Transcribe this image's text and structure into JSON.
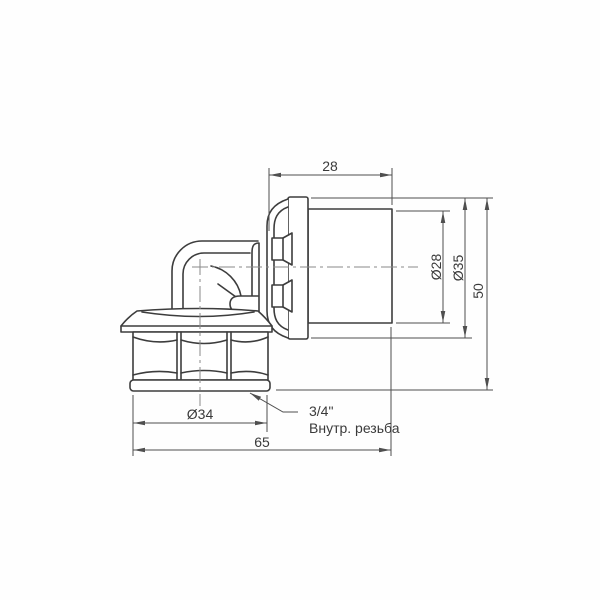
{
  "drawing": {
    "type": "technical-dimension-drawing",
    "subject": "press-elbow-fitting-with-female-thread",
    "colors": {
      "background": "#fefefe",
      "part_line": "#3d3d3d",
      "dimension_line": "#4f4f4f",
      "centerline": "#8a8a8a",
      "text": "#3a3a3a"
    },
    "labels": {
      "sleeve_length": "28",
      "sleeve_diameter": "Ø28",
      "flange_diameter": "Ø35",
      "overall_height": "50",
      "nut_diameter": "Ø34",
      "overall_width": "65"
    },
    "note": {
      "line1": "3/4\"",
      "line2": "Внутр. резьба"
    }
  }
}
